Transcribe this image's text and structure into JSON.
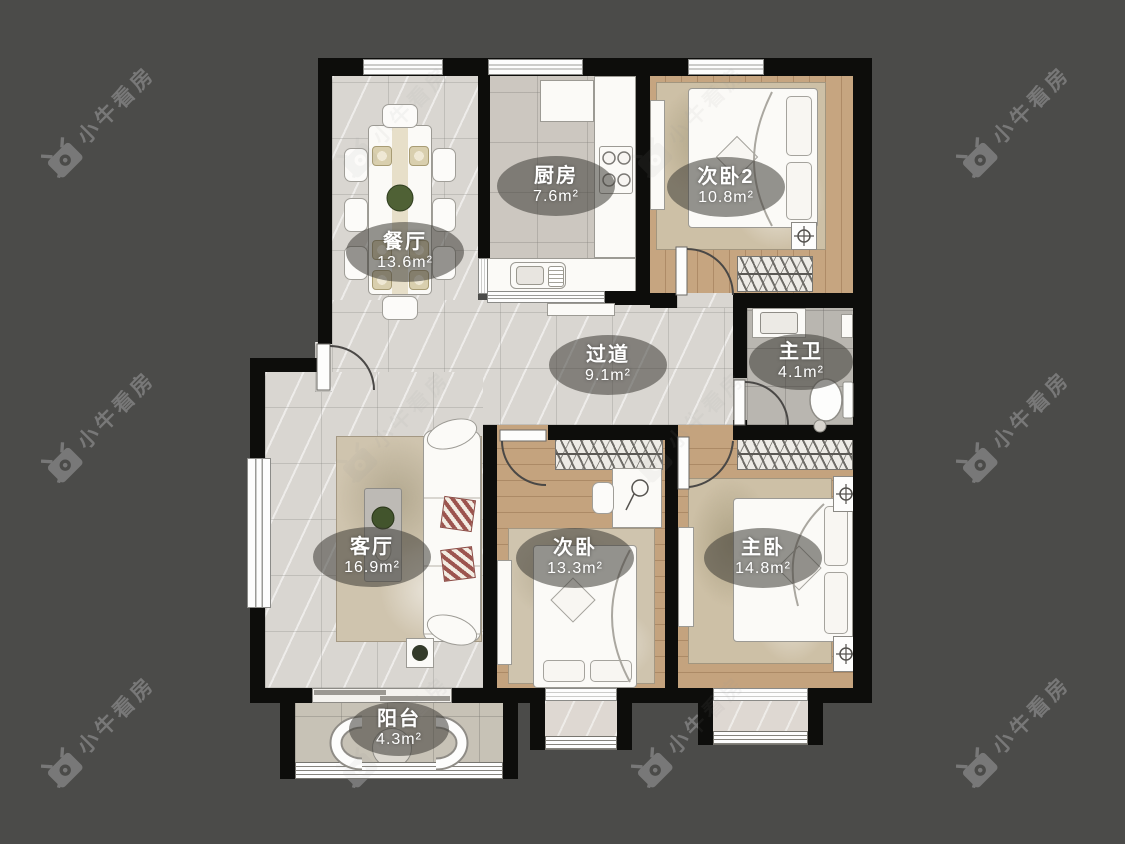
{
  "watermark": {
    "text": "小牛看房",
    "logo": "niuniu-cow-logo"
  },
  "rooms": [
    {
      "name": "餐厅",
      "area": "13.6m²"
    },
    {
      "name": "厨房",
      "area": "7.6m²"
    },
    {
      "name": "次卧2",
      "area": "10.8m²"
    },
    {
      "name": "过道",
      "area": "9.1m²"
    },
    {
      "name": "主卫",
      "area": "4.1m²"
    },
    {
      "name": "客厅",
      "area": "16.9m²"
    },
    {
      "name": "次卧",
      "area": "13.3m²"
    },
    {
      "name": "主卧",
      "area": "14.8m²"
    },
    {
      "name": "阳台",
      "area": "4.3m²"
    }
  ],
  "colors": {
    "background": "#4b4b49",
    "walls": "#0d0d0b",
    "floor_marble": "#d9d6d1",
    "floor_wood": "#c4a37e",
    "floor_kitchen_tile": "#ccc7c0",
    "floor_bath_tile": "#b9b6b0",
    "label_bubble": "rgba(62,60,55,0.55)",
    "label_text": "#ffffff",
    "watermark": "#9a9a9a"
  }
}
